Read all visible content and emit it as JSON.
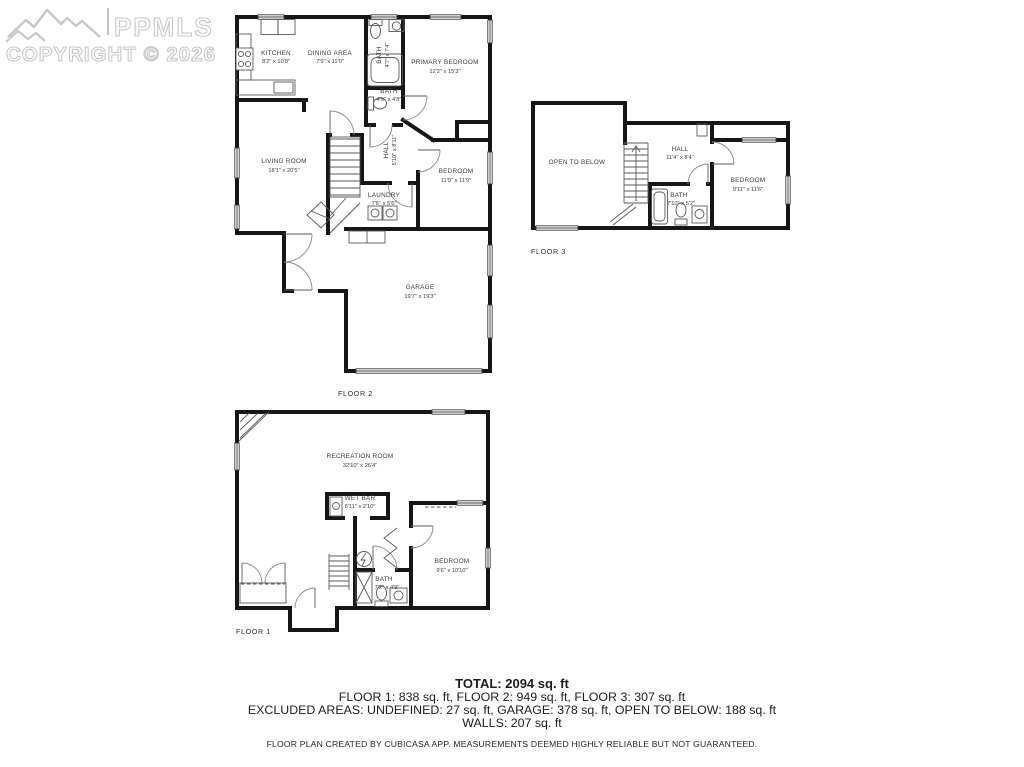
{
  "watermark": {
    "brand": "PPMLS",
    "copyright": "COPYRIGHT © 2026"
  },
  "floors": {
    "floor2": {
      "label": "FLOOR 2",
      "rooms": {
        "kitchen": {
          "name": "KITCHEN",
          "dims": "8'2\" x 10'8\""
        },
        "dining": {
          "name": "DINING AREA",
          "dims": "7'9\" x 11'0\""
        },
        "bath_upper": {
          "name": "BATH",
          "dims": "4'7\" x 7'4\""
        },
        "primary": {
          "name": "PRIMARY BEDROOM",
          "dims": "12'2\" x 15'3\""
        },
        "bath_lower": {
          "name": "BATH",
          "dims": "4'9\" x 4'8\""
        },
        "hall": {
          "name": "HALL",
          "dims": "5'10\" x 8'11\""
        },
        "living": {
          "name": "LIVING ROOM",
          "dims": "18'1\" x 20'5\""
        },
        "bedroom": {
          "name": "BEDROOM",
          "dims": "11'9\" x 11'9\""
        },
        "laundry": {
          "name": "LAUNDRY",
          "dims": "7'6\" x 5'6\""
        },
        "garage": {
          "name": "GARAGE",
          "dims": "19'7\" x 19'3\""
        }
      }
    },
    "floor3": {
      "label": "FLOOR 3",
      "rooms": {
        "open": {
          "name": "OPEN TO BELOW",
          "dims": ""
        },
        "hall": {
          "name": "HALL",
          "dims": "11'4\" x 8'4\""
        },
        "bath": {
          "name": "BATH",
          "dims": "7'10\" x 5'2\""
        },
        "bedroom": {
          "name": "BEDROOM",
          "dims": "9'11\" x 11'6\""
        }
      }
    },
    "floor1": {
      "label": "FLOOR 1",
      "rooms": {
        "rec": {
          "name": "RECREATION ROOM",
          "dims": "32'10\" x 26'4\""
        },
        "wetbar": {
          "name": "WET BAR",
          "dims": "8'11\" x 2'10\""
        },
        "bedroom": {
          "name": "BEDROOM",
          "dims": "9'6\" x 10'10\""
        },
        "bath": {
          "name": "BATH",
          "dims": "7'2\" x 4'9\""
        }
      }
    }
  },
  "summary": {
    "total": "TOTAL: 2094 sq. ft",
    "floors_line": "FLOOR 1: 838 sq. ft, FLOOR 2: 949 sq. ft, FLOOR 3: 307 sq. ft",
    "excluded_line": "EXCLUDED AREAS: UNDEFINED: 27 sq. ft, GARAGE: 378 sq. ft, OPEN TO BELOW: 188 sq. ft",
    "walls_line": "WALLS: 207 sq. ft",
    "disclaimer": "FLOOR PLAN CREATED BY CUBICASA APP. MEASUREMENTS DEEMED HIGHLY RELIABLE BUT NOT GUARANTEED."
  }
}
